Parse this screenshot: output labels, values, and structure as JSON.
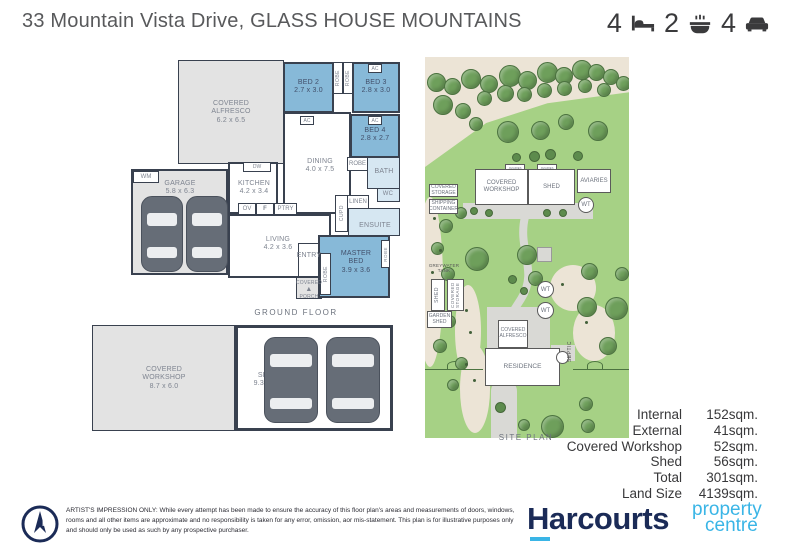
{
  "header": {
    "title": "33 Mountain Vista Drive, GLASS HOUSE MOUNTAINS",
    "beds": "4",
    "baths": "2",
    "cars": "4"
  },
  "floorplan": {
    "section_label": "GROUND FLOOR",
    "alfresco_name": "COVERED",
    "alfresco_name2": "ALFRESCO",
    "alfresco_dims": "6.2 x 6.5",
    "bed2_name": "BED 2",
    "bed2_dims": "2.7 x 3.0",
    "bed3_name": "BED 3",
    "bed3_dims": "2.8 x 3.0",
    "bed4_name": "BED 4",
    "bed4_dims": "2.8 x 2.7",
    "dining_name": "DINING",
    "dining_dims": "4.0 x 7.5",
    "kitchen_name": "KITCHEN",
    "kitchen_dims": "4.2 x 3.4",
    "garage_name": "GARAGE",
    "garage_dims": "5.8 x 6.3",
    "living_name": "LIVING",
    "living_dims": "4.2 x 3.6",
    "master_name": "MASTER",
    "master_name2": "BED",
    "master_dims": "3.9 x 3.6",
    "entry": "ENTRY",
    "porch1": "COVERED",
    "porch2": "PORCH",
    "ensuite": "ENSUITE",
    "bath": "BATH",
    "wc": "WC",
    "robe": "ROBE",
    "linen": "LINEN",
    "cupd": "CUPD",
    "wm": "WM",
    "dw": "DW",
    "ov": "OV",
    "fridge": "F",
    "pantry": "PTRY",
    "ac": "AC"
  },
  "outbuildings": {
    "workshop_name": "COVERED",
    "workshop_name2": "WORKSHOP",
    "workshop_dims": "8.7 x 6.0",
    "shed_name": "SHED",
    "shed_dims": "9.3 x 6.0"
  },
  "siteplan": {
    "section_label": "SITE PLAN",
    "covered_workshop1": "COVERED",
    "covered_workshop2": "WORKSHOP",
    "shed": "SHED",
    "aviaries": "AVIARIES",
    "wt": "WT",
    "covered_storage1": "COVERED",
    "covered_storage2": "STORAGE",
    "covered_storage_vert": "COVERED STORAGE",
    "shipping_container1": "SHIPPING",
    "shipping_container2": "CONTAINER",
    "greywater_tank1": "GREYWATER",
    "greywater_tank2": "TANK",
    "garden_shed1": "GARDEN",
    "garden_shed2": "SHED",
    "covered_alfresco1": "COVERED",
    "covered_alfresco2": "ALFRESCO",
    "residence": "RESIDENCE",
    "septic": "SEPTIC"
  },
  "measurements": {
    "rows": [
      {
        "label": "Internal",
        "value": "152sqm."
      },
      {
        "label": "External",
        "value": "41sqm."
      },
      {
        "label": "Covered Workshop",
        "value": "52sqm."
      },
      {
        "label": "Shed",
        "value": "56sqm."
      },
      {
        "label": "Total",
        "value": "301sqm."
      },
      {
        "label": "Land Size",
        "value": "4139sqm."
      }
    ]
  },
  "branding": {
    "name": "Harcourts",
    "tagline_line1": "property",
    "tagline_line2": "centre",
    "navy": "#1b2b57",
    "cyan": "#3ab5e6"
  },
  "footer": {
    "disclaimer": "ARTIST'S IMPRESSION ONLY: While every attempt has been made to ensure the accuracy of this floor plan's areas and measurements of doors, windows, rooms and all other items are approximate and no responsibility is taken for any error, omission, aor mis-statement. This plan is for illustrative purposes only and should only be used as such by any prospective purchaser."
  },
  "colors": {
    "bedroom_blue": "#87b9d8",
    "wet_area_blue": "#d6e7f2",
    "hard_area_grey": "#e3e3e3",
    "wall": "#39414f",
    "grass_green": "#a6d185",
    "tree_green": "#6e9f5b"
  }
}
